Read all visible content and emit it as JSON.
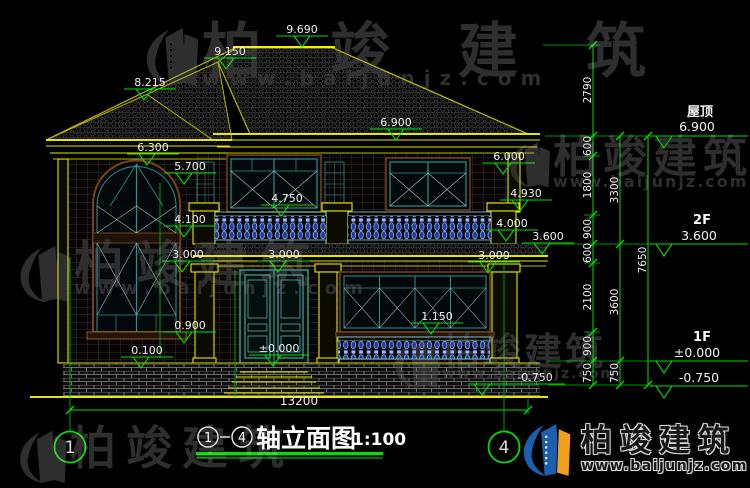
{
  "drawing": {
    "title_axis_start": "1",
    "title_axis_end": "4",
    "title_sep": "-",
    "title_text": "轴立面图",
    "title_scale": "1:100",
    "bottom_dim": "13200",
    "axis_left": "1",
    "axis_right": "4"
  },
  "marks": {
    "ridge": "9.690",
    "hip_upper": "9.150",
    "hip_lower": "8.215",
    "eave_main": "6.900",
    "eave_wing": "6.300",
    "win2f_top": "6.000",
    "arch_top": "5.700",
    "porch_beam": "4.930",
    "rail2f_top": "4.750",
    "wing_band": "4.100",
    "balcony_floor": "4.000",
    "porch_eave": "3.600",
    "win1f_top_left": "3.000",
    "win1f_top_center": "3.000",
    "win1f_top_right": "3.000",
    "rail1f_top": "1.150",
    "sill_1f": "0.900",
    "plinth_top": "0.100",
    "ground_zero": "±0.000",
    "site_level": "-0.750"
  },
  "chain1": [
    "2790",
    "600",
    "1800",
    "900",
    "600",
    "2100",
    "900",
    "750"
  ],
  "chain2": [
    "3300",
    "3600",
    "750"
  ],
  "chain3": [
    "7650"
  ],
  "levels": [
    {
      "label": "屋顶",
      "value": "6.900"
    },
    {
      "label": "2F",
      "value": "3.600"
    },
    {
      "label": "1F",
      "value": "±0.000"
    },
    {
      "label": "",
      "value": "-0.750"
    }
  ],
  "watermark": {
    "brand": "柏竣建筑",
    "url": "www.baijunjz.com"
  },
  "logo": {
    "brand": "柏竣建筑",
    "url": "www.baijunjz.com"
  },
  "colors": {
    "dim_green": "#00e000",
    "line_yellow": "#e6e600",
    "frame_teal": "#2e8f8f",
    "logo_blue": "#1b5fae",
    "logo_orange": "#f0a01e"
  }
}
